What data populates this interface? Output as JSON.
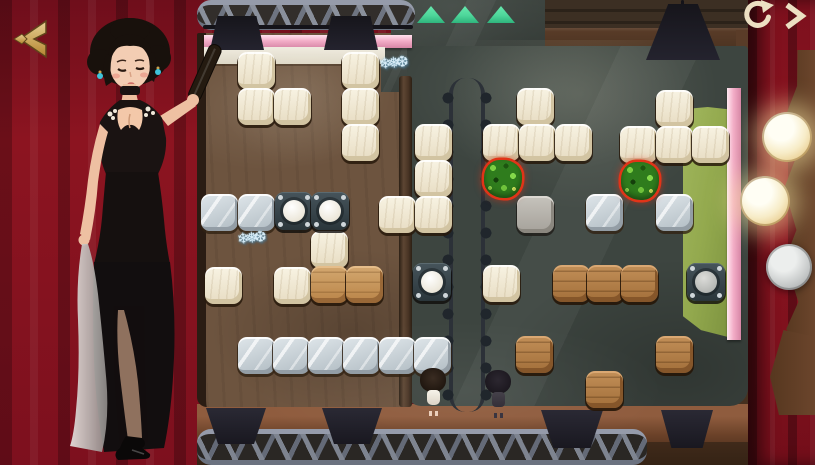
{
  "header": {
    "back_icon": "gold-back-chevrons-icon",
    "restart_icon": "restart-circular-arrow-icon",
    "next_icon": "next-chevron-icon",
    "back_label": "back",
    "restart_label": "restart level",
    "next_label": "next level"
  },
  "stage": {
    "exit_arrow_count": 3,
    "exit_arrow_direction": "up",
    "hostess_label": "hostess in black qipao holding folded fan"
  },
  "progress_lights": {
    "lights": [
      {
        "state": "lit",
        "x": 762,
        "y": 112,
        "d": 50
      },
      {
        "state": "lit",
        "x": 740,
        "y": 176,
        "d": 50
      },
      {
        "state": "unlit",
        "x": 766,
        "y": 244,
        "d": 46
      }
    ]
  },
  "board": {
    "interactable_types": [
      "white",
      "glass",
      "wood",
      "wood-light",
      "stone",
      "bush"
    ],
    "glyphs": {
      "ice": "❄❅❆"
    },
    "tiles": [
      {
        "type": "marker",
        "x": 417,
        "y": 6,
        "w": 28,
        "h": 17
      },
      {
        "type": "marker",
        "x": 451,
        "y": 6,
        "w": 28,
        "h": 17
      },
      {
        "type": "marker",
        "x": 487,
        "y": 6,
        "w": 28,
        "h": 17
      },
      {
        "type": "white",
        "x": 238,
        "y": 52
      },
      {
        "type": "white",
        "x": 238,
        "y": 88
      },
      {
        "type": "white",
        "x": 274,
        "y": 88
      },
      {
        "type": "white",
        "x": 342,
        "y": 52
      },
      {
        "type": "white",
        "x": 342,
        "y": 88
      },
      {
        "type": "white",
        "x": 342,
        "y": 124
      },
      {
        "type": "white",
        "x": 415,
        "y": 124
      },
      {
        "type": "white",
        "x": 415,
        "y": 160
      },
      {
        "type": "white",
        "x": 379,
        "y": 196
      },
      {
        "type": "white",
        "x": 415,
        "y": 196
      },
      {
        "type": "white",
        "x": 311,
        "y": 231
      },
      {
        "type": "white",
        "x": 205,
        "y": 267
      },
      {
        "type": "white",
        "x": 274,
        "y": 267
      },
      {
        "type": "white",
        "x": 517,
        "y": 88
      },
      {
        "type": "white",
        "x": 483,
        "y": 124
      },
      {
        "type": "white",
        "x": 519,
        "y": 124
      },
      {
        "type": "white",
        "x": 555,
        "y": 124
      },
      {
        "type": "white",
        "x": 656,
        "y": 90
      },
      {
        "type": "white",
        "x": 620,
        "y": 126
      },
      {
        "type": "white",
        "x": 656,
        "y": 126
      },
      {
        "type": "white",
        "x": 692,
        "y": 126
      },
      {
        "type": "white",
        "x": 483,
        "y": 265
      },
      {
        "type": "glass",
        "x": 201,
        "y": 194
      },
      {
        "type": "glass",
        "x": 238,
        "y": 194
      },
      {
        "type": "glass",
        "x": 238,
        "y": 337
      },
      {
        "type": "glass",
        "x": 273,
        "y": 337
      },
      {
        "type": "glass",
        "x": 308,
        "y": 337
      },
      {
        "type": "glass",
        "x": 343,
        "y": 337
      },
      {
        "type": "glass",
        "x": 379,
        "y": 337
      },
      {
        "type": "glass",
        "x": 414,
        "y": 337
      },
      {
        "type": "glass",
        "x": 586,
        "y": 194
      },
      {
        "type": "glass",
        "x": 656,
        "y": 194
      },
      {
        "type": "stone",
        "x": 517,
        "y": 196
      },
      {
        "type": "wood-light",
        "x": 311,
        "y": 266
      },
      {
        "type": "wood-light",
        "x": 346,
        "y": 266
      },
      {
        "type": "wood",
        "x": 553,
        "y": 265
      },
      {
        "type": "wood",
        "x": 587,
        "y": 265
      },
      {
        "type": "wood",
        "x": 621,
        "y": 265
      },
      {
        "type": "wood",
        "x": 516,
        "y": 336
      },
      {
        "type": "wood",
        "x": 656,
        "y": 336
      },
      {
        "type": "wood",
        "x": 586,
        "y": 371
      },
      {
        "type": "socket",
        "x": 275,
        "y": 192,
        "w": 38,
        "h": 38
      },
      {
        "type": "socket",
        "x": 311,
        "y": 192,
        "w": 38,
        "h": 38
      },
      {
        "type": "socket",
        "x": 413,
        "y": 263,
        "w": 38,
        "h": 38
      },
      {
        "type": "socket-gray",
        "x": 687,
        "y": 263,
        "w": 38,
        "h": 38
      },
      {
        "type": "bush",
        "x": 484,
        "y": 160,
        "w": 38,
        "h": 38
      },
      {
        "type": "bush",
        "x": 621,
        "y": 162,
        "w": 38,
        "h": 38
      },
      {
        "type": "ice",
        "x": 380,
        "y": 54,
        "w": 40,
        "h": 36
      },
      {
        "type": "ice",
        "x": 238,
        "y": 229,
        "w": 40,
        "h": 36
      },
      {
        "type": "char-girl",
        "x": 420,
        "y": 366,
        "w": 27,
        "h": 44
      },
      {
        "type": "char-shadow",
        "x": 485,
        "y": 368,
        "w": 27,
        "h": 42
      }
    ]
  },
  "colors": {
    "curtain": "#8c1420",
    "curtain-dark": "#6f0e1b",
    "gold": "#c9a155",
    "cream": "#ecdfc2",
    "pink": "#f3aec8",
    "mint": "#4ed69a",
    "floor-left": "#6d543f",
    "floor-right": "#3d4540",
    "mat-green": "#93a94e",
    "bulb-warm": "#f7ecc8"
  }
}
